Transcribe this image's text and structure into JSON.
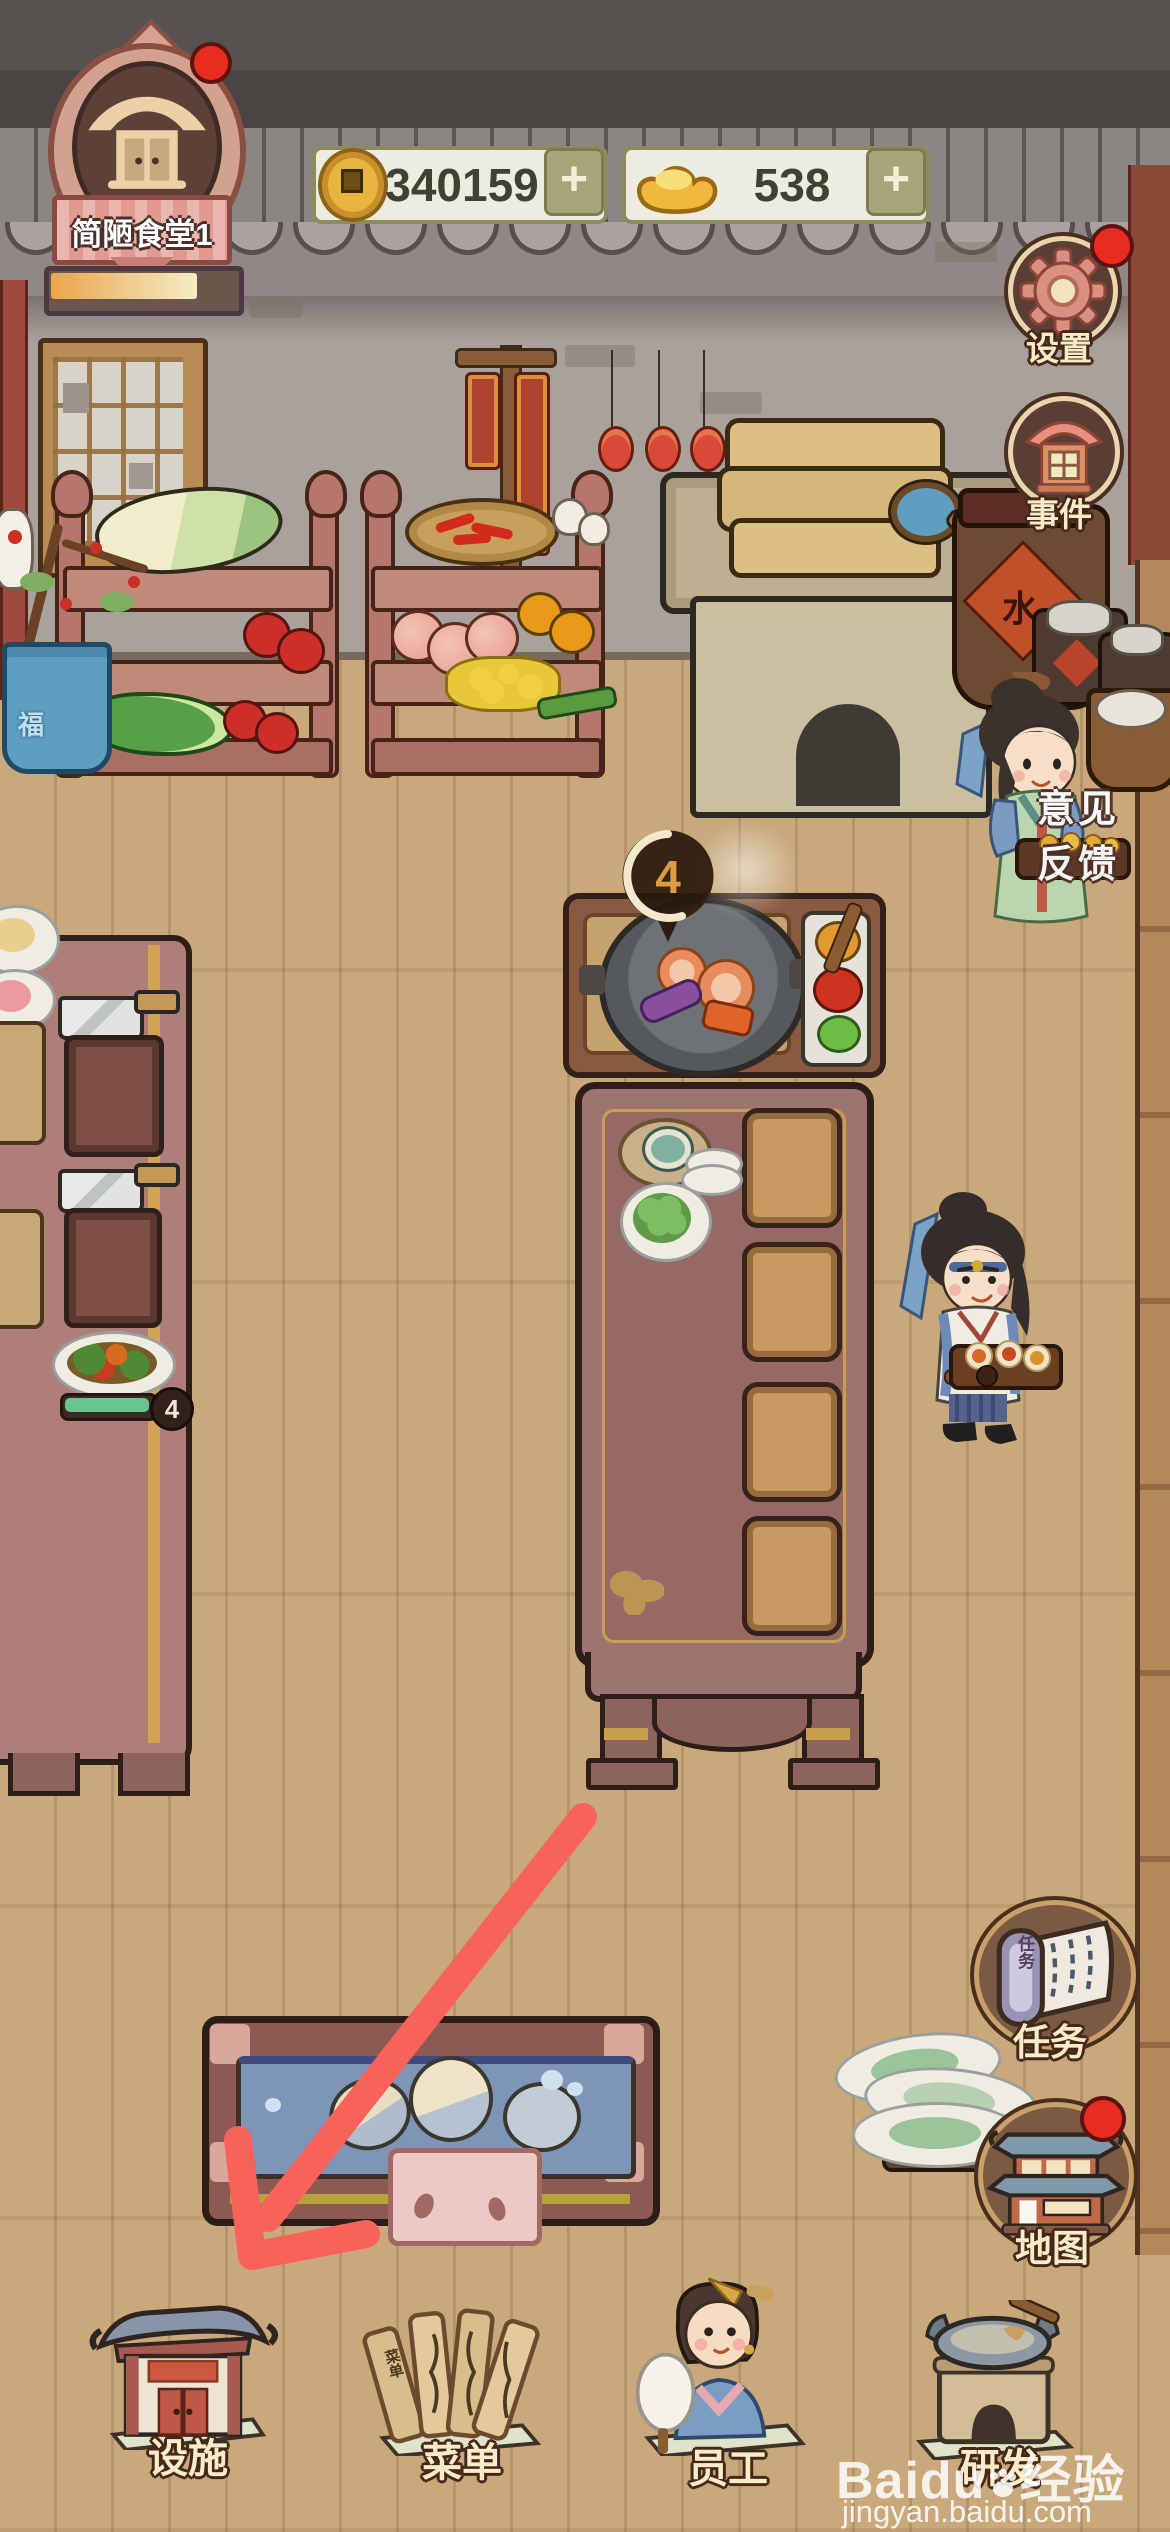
{
  "hud": {
    "restaurant": {
      "name": "简陋食堂1",
      "stars_filled": 1,
      "stars_total": 3,
      "progress_percent": 78
    },
    "currencies": [
      {
        "id": "copper-coins",
        "icon": "copper-coin-icon",
        "value": "340159",
        "plus_label": "+"
      },
      {
        "id": "gold-ingots",
        "icon": "gold-ingot-icon",
        "value": "538",
        "plus_label": "+"
      }
    ],
    "right_buttons": [
      {
        "id": "settings",
        "label": "设置",
        "icon": "gear-icon",
        "has_notification": true
      },
      {
        "id": "events",
        "label": "事件",
        "icon": "house-icon",
        "has_notification": false
      }
    ],
    "feedback_tab": {
      "line1": "意见",
      "line2": "反馈"
    },
    "lower_right_buttons": [
      {
        "id": "tasks",
        "label": "任务",
        "icon": "scroll-icon",
        "icon_text": "任务",
        "has_notification": false
      },
      {
        "id": "map",
        "label": "地图",
        "icon": "town-building-icon",
        "has_notification": true
      }
    ],
    "bottom_bar": [
      {
        "id": "facilities",
        "label": "设施",
        "icon": "pavilion-icon"
      },
      {
        "id": "menu",
        "label": "菜单",
        "icon": "bamboo-menu-icon",
        "icon_text": "菜单"
      },
      {
        "id": "staff",
        "label": "员工",
        "icon": "staff-woman-icon"
      },
      {
        "id": "research",
        "label": "研发",
        "icon": "stove-wok-icon"
      }
    ]
  },
  "scene": {
    "cooking_bubble_count": "4",
    "ready_dish_count": "4",
    "water_jar_label": "水",
    "bonsai_pot_label": "福"
  },
  "watermark": {
    "brand": "Baidu",
    "brand_cn": "经验",
    "url": "jingyan.baidu.com"
  },
  "colors": {
    "floor": "#c9a87c",
    "wall": "#a8a19c",
    "roof": "#4f4a48",
    "accent_gold": "#d8a94e",
    "table_mauve": "#9d7470",
    "hud_field": "#ecece0",
    "notification_red": "#e82a1f",
    "arrow_red": "#f8625a",
    "progress_green": "#67c690"
  }
}
